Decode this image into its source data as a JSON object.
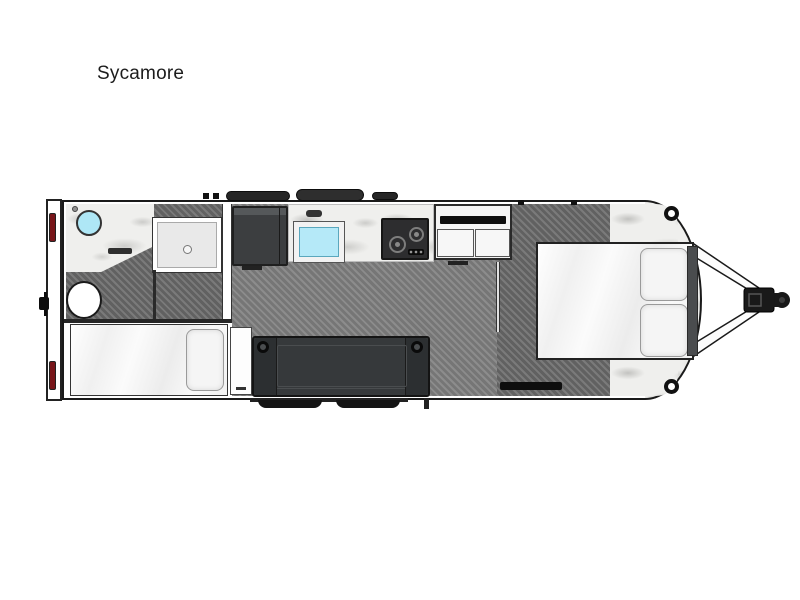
{
  "title": "Sycamore",
  "floorplan": {
    "model_name": "Sycamore",
    "view": "top-down-floorplan",
    "features": [
      "rear-bumper",
      "tail-lights",
      "bathroom-vanity",
      "round-sink",
      "toilet",
      "shower",
      "wardrobe-cabinet",
      "kitchen-counter",
      "kitchen-sink",
      "cooktop",
      "media-cabinet",
      "twin-bed",
      "nightstand",
      "sofa",
      "entry-steps",
      "queen-bed",
      "pillows",
      "headboard",
      "front-cap",
      "speakers",
      "a-frame-hitch",
      "roof-vents"
    ],
    "colors": {
      "background": "#ffffff",
      "outline_black": "#1a1a1a",
      "sink_blue": "#aee7f6",
      "kitchen_sink_blue": "#b5e9f8",
      "tail_light_red": "#78161a",
      "floor_gray": "#7e7e7e",
      "bedroom_floor_gray": "#6b6b6b",
      "marble_counter": "#efefed",
      "sofa_charcoal": "#36393b",
      "cabinet_dark": "#3c3e40"
    }
  }
}
